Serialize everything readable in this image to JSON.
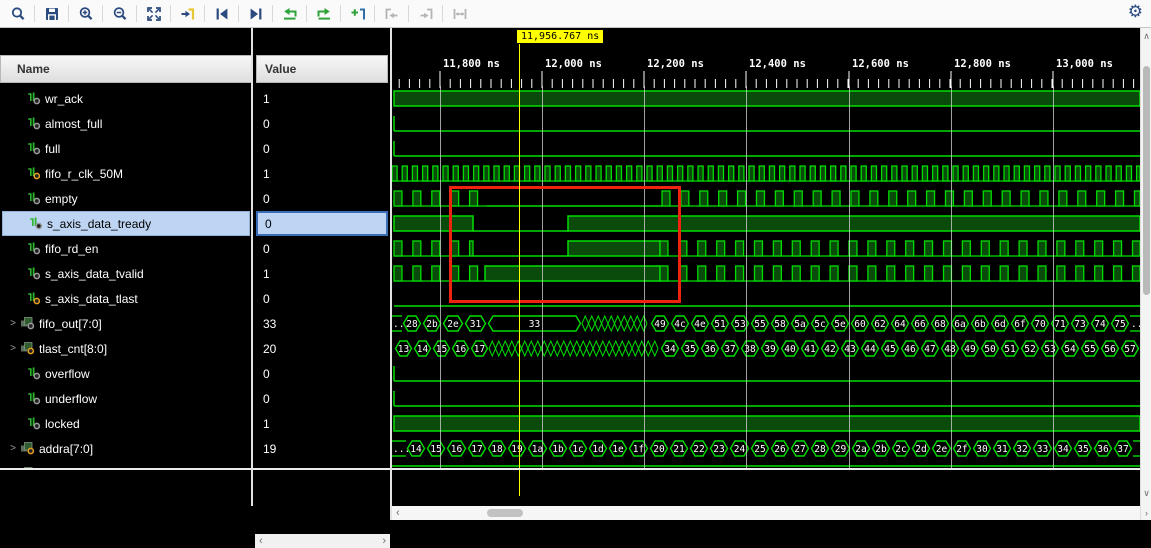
{
  "toolbar": {
    "icons": [
      "search",
      "save",
      "zoom-in",
      "zoom-out",
      "zoom-fit",
      "go-to-time-cursor",
      "previous-transition",
      "next-transition",
      "previous-edge",
      "next-edge",
      "add-marker",
      "jump-to-left-disabled",
      "jump-to-right-disabled",
      "span-markers-disabled"
    ],
    "settings_icon": "gear"
  },
  "panel": {
    "name_header": "Name",
    "value_header": "Value"
  },
  "timeline": {
    "cursor_label": "11,956.767 ns",
    "cursor_x": 127,
    "ticks": [
      {
        "label": "11,800 ns",
        "x": 48
      },
      {
        "label": "12,000 ns",
        "x": 150
      },
      {
        "label": "12,200 ns",
        "x": 252
      },
      {
        "label": "12,400 ns",
        "x": 354
      },
      {
        "label": "12,600 ns",
        "x": 457
      },
      {
        "label": "12,800 ns",
        "x": 559
      },
      {
        "label": "13,000 ns",
        "x": 661
      }
    ],
    "minor_step": 10.2
  },
  "colors": {
    "wave_green": "#00dd00",
    "wave_fill": "#0a4a0a",
    "cursor_yellow": "#ffff00",
    "marker_red": "#ee2411",
    "selection_blue": "#bdd4f2",
    "selection_border": "#3a6db8",
    "icon_navy": "#2b4a80",
    "icon_green": "#2fa339",
    "icon_yellow": "#e6c832",
    "icon_gray": "#b4b4b4"
  },
  "watermark": "CSDN @wuzhirui志锐",
  "signals": [
    {
      "name": "wr_ack",
      "value": "1",
      "kind": "bit",
      "dot": "gray",
      "wave": [
        [
          "high",
          2,
          748
        ]
      ]
    },
    {
      "name": "almost_full",
      "value": "0",
      "kind": "bit",
      "dot": "gray",
      "wave": [
        [
          "fall",
          2
        ],
        [
          "low",
          2,
          748
        ]
      ]
    },
    {
      "name": "full",
      "value": "0",
      "kind": "bit",
      "dot": "gray",
      "wave": [
        [
          "fall",
          2
        ],
        [
          "low",
          2,
          748
        ]
      ]
    },
    {
      "name": "fifo_r_clk_50M",
      "value": "1",
      "kind": "bit",
      "dot": "orange",
      "wave": [
        [
          "clock",
          0,
          748,
          10.2,
          0.5
        ]
      ]
    },
    {
      "name": "empty",
      "value": "0",
      "kind": "bit",
      "dot": "gray",
      "wave": [
        [
          "pulses",
          2,
          95,
          18.9,
          0.42
        ],
        [
          "low",
          95,
          270
        ],
        [
          "pulses",
          270,
          748,
          18.9,
          0.42
        ]
      ]
    },
    {
      "name": "s_axis_data_tready",
      "value": "0",
      "kind": "bit",
      "dot": "gray",
      "selected": true,
      "wave": [
        [
          "high",
          2,
          81
        ],
        [
          "low",
          81,
          176
        ],
        [
          "high",
          176,
          748
        ]
      ]
    },
    {
      "name": "fifo_rd_en",
      "value": "0",
      "kind": "bit",
      "dot": "gray",
      "wave": [
        [
          "pulses",
          2,
          81,
          18.9,
          0.42
        ],
        [
          "low",
          81,
          176
        ],
        [
          "high",
          176,
          268
        ],
        [
          "pulses",
          268,
          748,
          18.9,
          0.42
        ]
      ]
    },
    {
      "name": "s_axis_data_tvalid",
      "value": "1",
      "kind": "bit",
      "dot": "gray",
      "wave": [
        [
          "pulses",
          2,
          93,
          18.9,
          0.42
        ],
        [
          "high",
          93,
          268
        ],
        [
          "pulses",
          268,
          748,
          18.9,
          0.42
        ]
      ]
    },
    {
      "name": "s_axis_data_tlast",
      "value": "0",
      "kind": "bit",
      "dot": "orange",
      "wave": [
        [
          "low",
          2,
          748
        ]
      ]
    },
    {
      "name": "fifo_out[7:0]",
      "value": "33",
      "kind": "bus",
      "dot": "gray",
      "expandable": true,
      "wave": [
        [
          "open",
          "...",
          0,
          10
        ],
        [
          "cell",
          "28",
          10,
          30
        ],
        [
          "cell",
          "2b",
          30,
          50
        ],
        [
          "cell",
          "2e",
          50,
          72
        ],
        [
          "cell",
          "31",
          72,
          95
        ],
        [
          "cell",
          "33",
          95,
          190
        ],
        [
          "dense",
          190,
          258
        ],
        [
          "cell",
          "49",
          258,
          278
        ],
        [
          "cell",
          "4c",
          278,
          298
        ],
        [
          "cell",
          "4e",
          298,
          318
        ],
        [
          "cell",
          "51",
          318,
          338
        ],
        [
          "cell",
          "53",
          338,
          358
        ],
        [
          "cell",
          "55",
          358,
          378
        ],
        [
          "cell",
          "58",
          378,
          398
        ],
        [
          "cell",
          "5a",
          398,
          418
        ],
        [
          "cell",
          "5c",
          418,
          438
        ],
        [
          "cell",
          "5e",
          438,
          458
        ],
        [
          "cell",
          "60",
          458,
          478
        ],
        [
          "cell",
          "62",
          478,
          498
        ],
        [
          "cell",
          "64",
          498,
          518
        ],
        [
          "cell",
          "66",
          518,
          538
        ],
        [
          "cell",
          "68",
          538,
          558
        ],
        [
          "cell",
          "6a",
          558,
          578
        ],
        [
          "cell",
          "6b",
          578,
          598
        ],
        [
          "cell",
          "6d",
          598,
          618
        ],
        [
          "cell",
          "6f",
          618,
          638
        ],
        [
          "cell",
          "70",
          638,
          658
        ],
        [
          "cell",
          "71",
          658,
          678
        ],
        [
          "cell",
          "73",
          678,
          698
        ],
        [
          "cell",
          "74",
          698,
          718
        ],
        [
          "cell",
          "75",
          718,
          738
        ],
        [
          "open",
          "...",
          738,
          748
        ]
      ]
    },
    {
      "name": "tlast_cnt[8:0]",
      "value": "20",
      "kind": "bus",
      "dot": "orange",
      "expandable": true,
      "wave": [
        [
          "cell",
          "13",
          2,
          21
        ],
        [
          "cell",
          "14",
          21,
          40
        ],
        [
          "cell",
          "15",
          40,
          59
        ],
        [
          "cell",
          "16",
          59,
          78
        ],
        [
          "cell",
          "17",
          78,
          97
        ],
        [
          "dense",
          97,
          268
        ],
        [
          "cell",
          "34",
          268,
          288
        ],
        [
          "cell",
          "35",
          288,
          308
        ],
        [
          "cell",
          "36",
          308,
          328
        ],
        [
          "cell",
          "37",
          328,
          348
        ],
        [
          "cell",
          "38",
          348,
          368
        ],
        [
          "cell",
          "39",
          368,
          388
        ],
        [
          "cell",
          "40",
          388,
          408
        ],
        [
          "cell",
          "41",
          408,
          428
        ],
        [
          "cell",
          "42",
          428,
          448
        ],
        [
          "cell",
          "43",
          448,
          468
        ],
        [
          "cell",
          "44",
          468,
          488
        ],
        [
          "cell",
          "45",
          488,
          508
        ],
        [
          "cell",
          "46",
          508,
          528
        ],
        [
          "cell",
          "47",
          528,
          548
        ],
        [
          "cell",
          "48",
          548,
          568
        ],
        [
          "cell",
          "49",
          568,
          588
        ],
        [
          "cell",
          "50",
          588,
          608
        ],
        [
          "cell",
          "51",
          608,
          628
        ],
        [
          "cell",
          "52",
          628,
          648
        ],
        [
          "cell",
          "53",
          648,
          668
        ],
        [
          "cell",
          "54",
          668,
          688
        ],
        [
          "cell",
          "55",
          688,
          708
        ],
        [
          "cell",
          "56",
          708,
          728
        ],
        [
          "cell",
          "57",
          728,
          748
        ]
      ]
    },
    {
      "name": "overflow",
      "value": "0",
      "kind": "bit",
      "dot": "gray",
      "wave": [
        [
          "fall",
          2
        ],
        [
          "low",
          2,
          748
        ]
      ]
    },
    {
      "name": "underflow",
      "value": "0",
      "kind": "bit",
      "dot": "gray",
      "wave": [
        [
          "fall",
          2
        ],
        [
          "low",
          2,
          748
        ]
      ]
    },
    {
      "name": "locked",
      "value": "1",
      "kind": "bit",
      "dot": "gray",
      "wave": [
        [
          "high",
          2,
          748
        ]
      ]
    },
    {
      "name": "addra[7:0]",
      "value": "19",
      "kind": "bus",
      "dot": "orange",
      "expandable": true,
      "wave": [
        [
          "open",
          "...",
          0,
          14
        ],
        [
          "cell",
          "14",
          14,
          34
        ],
        [
          "cell",
          "15",
          34,
          54
        ],
        [
          "cell",
          "16",
          54,
          75
        ],
        [
          "cell",
          "17",
          75,
          95
        ],
        [
          "cell",
          "18",
          95,
          115
        ],
        [
          "cell",
          "19",
          115,
          135
        ],
        [
          "cell",
          "1a",
          135,
          156
        ],
        [
          "cell",
          "1b",
          156,
          176
        ],
        [
          "cell",
          "1c",
          176,
          196
        ],
        [
          "cell",
          "1d",
          196,
          216
        ],
        [
          "cell",
          "1e",
          216,
          236
        ],
        [
          "cell",
          "1f",
          236,
          257
        ],
        [
          "cell",
          "20",
          257,
          277
        ],
        [
          "cell",
          "21",
          277,
          297
        ],
        [
          "cell",
          "22",
          297,
          317
        ],
        [
          "cell",
          "23",
          317,
          337
        ],
        [
          "cell",
          "24",
          337,
          358
        ],
        [
          "cell",
          "25",
          358,
          378
        ],
        [
          "cell",
          "26",
          378,
          398
        ],
        [
          "cell",
          "27",
          398,
          418
        ],
        [
          "cell",
          "28",
          418,
          438
        ],
        [
          "cell",
          "29",
          438,
          459
        ],
        [
          "cell",
          "2a",
          459,
          479
        ],
        [
          "cell",
          "2b",
          479,
          499
        ],
        [
          "cell",
          "2c",
          499,
          519
        ],
        [
          "cell",
          "2d",
          519,
          539
        ],
        [
          "cell",
          "2e",
          539,
          560
        ],
        [
          "cell",
          "2f",
          560,
          580
        ],
        [
          "cell",
          "30",
          580,
          600
        ],
        [
          "cell",
          "31",
          600,
          620
        ],
        [
          "cell",
          "32",
          620,
          640
        ],
        [
          "cell",
          "33",
          640,
          661
        ],
        [
          "cell",
          "34",
          661,
          681
        ],
        [
          "cell",
          "35",
          681,
          701
        ],
        [
          "cell",
          "36",
          701,
          721
        ],
        [
          "cell",
          "37",
          721,
          741
        ],
        [
          "open",
          "",
          741,
          748
        ]
      ]
    },
    {
      "name": "…",
      "value": "…",
      "kind": "clipped",
      "dot": "gray",
      "expandable": true,
      "wave": [
        [
          "line-top",
          0,
          748
        ]
      ]
    }
  ]
}
